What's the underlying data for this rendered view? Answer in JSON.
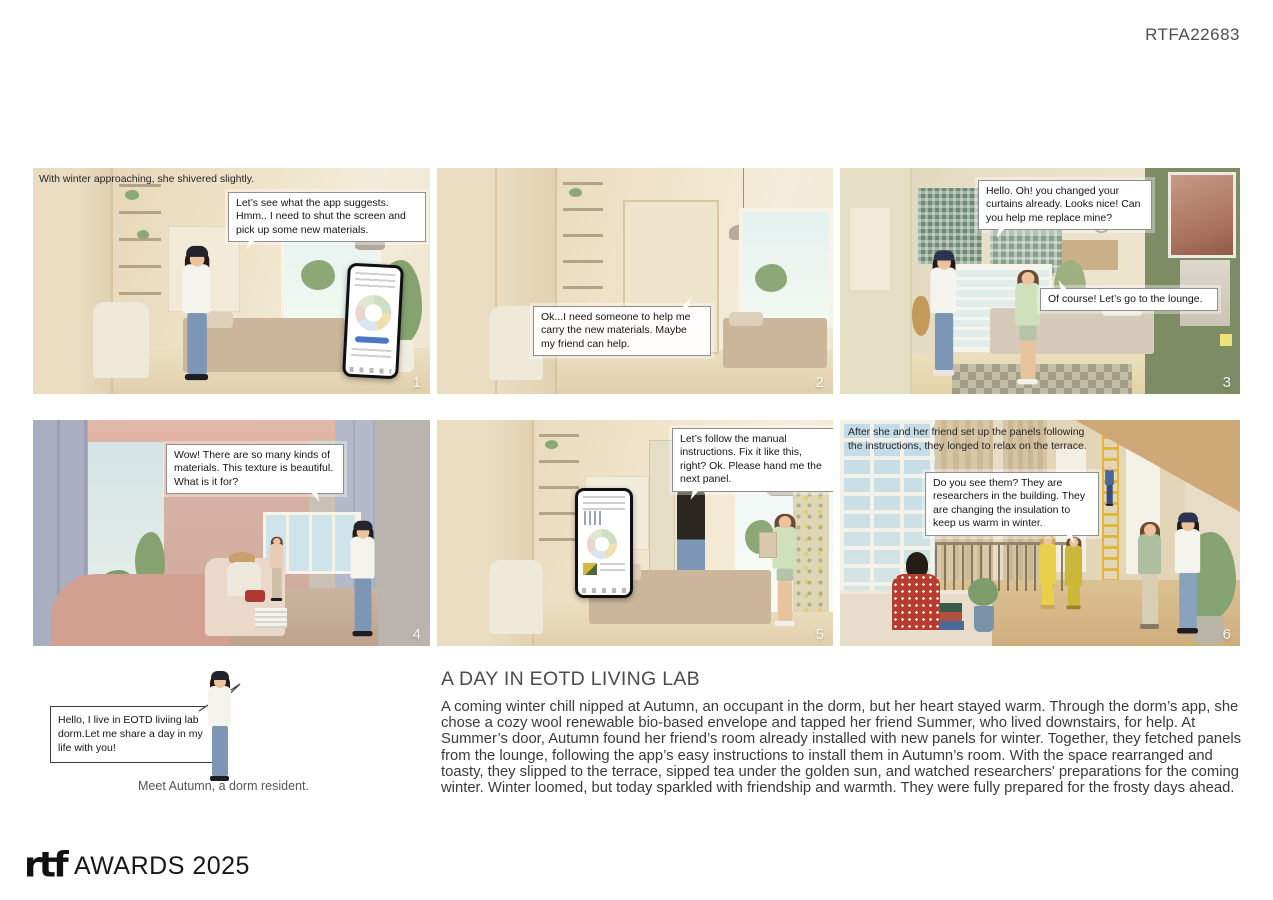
{
  "header": {
    "code": "RTFA22683"
  },
  "panels": [
    {
      "number": "1",
      "caption": "With winter approaching, she shivered slightly.",
      "bubble": "Let’s see what the app suggests. Hmm.. I need to shut the screen and pick up some new materials."
    },
    {
      "number": "2",
      "bubble": "Ok...I need someone to help me carry the new materials. Maybe my friend can help."
    },
    {
      "number": "3",
      "bubble": "Hello. Oh! you changed your curtains already. Looks nice! Can you help me replace mine?",
      "bubble_reply": "Of course! Let’s go to the lounge."
    },
    {
      "number": "4",
      "bubble": "Wow! There are so many kinds of materials. This texture is beautiful. What is it for?"
    },
    {
      "number": "5",
      "bubble": "Let’s follow the manual instructions. Fix it like this, right? Ok. Please hand me the next panel."
    },
    {
      "number": "6",
      "caption": "After she and her friend set up the panels following the instructions, they longed to relax on the terrace.",
      "bubble": "Do you see them? They are researchers in the building. They are changing the insulation to keep us warm in winter."
    }
  ],
  "story": {
    "title": "A DAY IN EOTD LIVING LAB",
    "body": "A coming winter chill nipped at Autumn, an occupant in the dorm, but her heart stayed warm. Through the dorm’s app, she chose a cozy wool renewable bio-based envelope and tapped her friend Summer, who lived downstairs, for help. At Summer’s door, Autumn found her friend’s room already installed with new panels for winter. Together, they fetched panels from the lounge, following the app’s easy instructions to install them in Autumn’s room. With the space rearranged and toasty, they slipped to the terrace, sipped tea under the golden sun, and watched researchers' preparations for the coming winter. Winter loomed, but today sparkled with friendship and warmth. They were fully prepared for the frosty days ahead."
  },
  "intro": {
    "bubble": "Hello, I live in EOTD liviing lab dorm.Let me share a day in my life with you!",
    "caption": "Meet Autumn, a dorm resident."
  },
  "footer": {
    "logo": "rtf",
    "label": "AWARDS 2025"
  },
  "colors": {
    "accent_green_wall": "#7e8c66",
    "accent_mauve": "#d2a090",
    "room_beige": "#e9dcc0",
    "ladder_yellow": "#e0b73c"
  }
}
